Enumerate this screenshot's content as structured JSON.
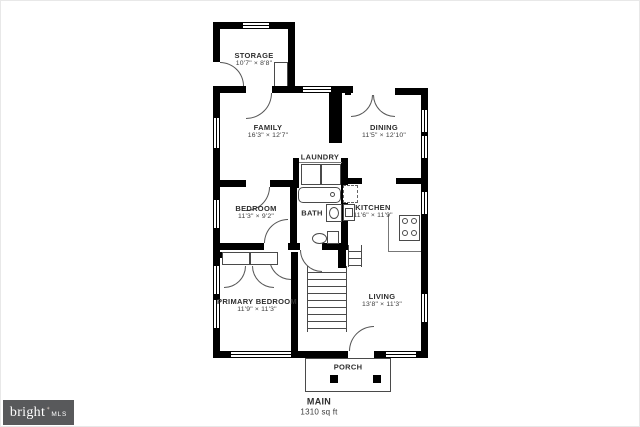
{
  "plan": {
    "rooms": [
      {
        "name": "STORAGE",
        "dims": "10'7\" × 8'8\""
      },
      {
        "name": "FAMILY",
        "dims": "16'3\" × 12'7\""
      },
      {
        "name": "DINING",
        "dims": "11'5\" × 12'10\""
      },
      {
        "name": "LAUNDRY"
      },
      {
        "name": "BEDROOM",
        "dims": "11'3\" × 9'2\""
      },
      {
        "name": "BATH"
      },
      {
        "name": "KITCHEN",
        "dims": "11'6\" × 11'9\""
      },
      {
        "name": "PRIMARY BEDROOM",
        "dims": "11'9\" × 11'3\""
      },
      {
        "name": "LIVING",
        "dims": "13'8\" × 11'3\""
      },
      {
        "name": "PORCH"
      }
    ],
    "footer": {
      "level": "MAIN",
      "area": "1310 sq ft"
    }
  },
  "logo": {
    "brand": "bright",
    "mark": "✶",
    "sub": "MLS"
  },
  "colors": {
    "wall": "#000000",
    "badge_bg": "#58595b"
  }
}
